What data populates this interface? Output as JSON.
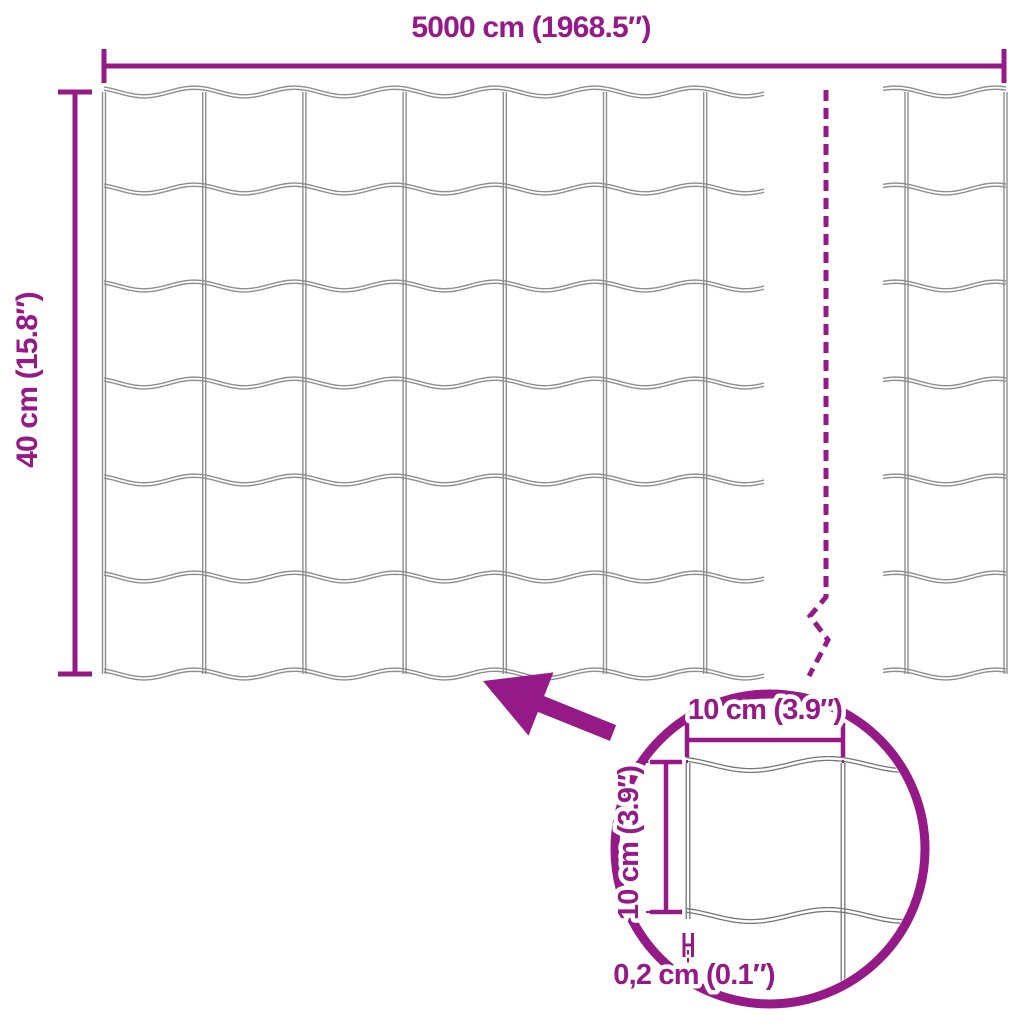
{
  "diagram": {
    "roll": {
      "width_label": "5000 cm (1968.5″)",
      "height_label": "40 cm (15.8″)"
    },
    "detail": {
      "mesh_width_label": "10 cm (3.9″)",
      "mesh_height_label": "10 cm (3.9″)",
      "wire_thickness_label": "0,2 cm (0.1″)"
    },
    "colors": {
      "accent": "#951a87",
      "wire": "#8e8e8e",
      "wire_detail": "#767676",
      "background": "#ffffff"
    }
  }
}
